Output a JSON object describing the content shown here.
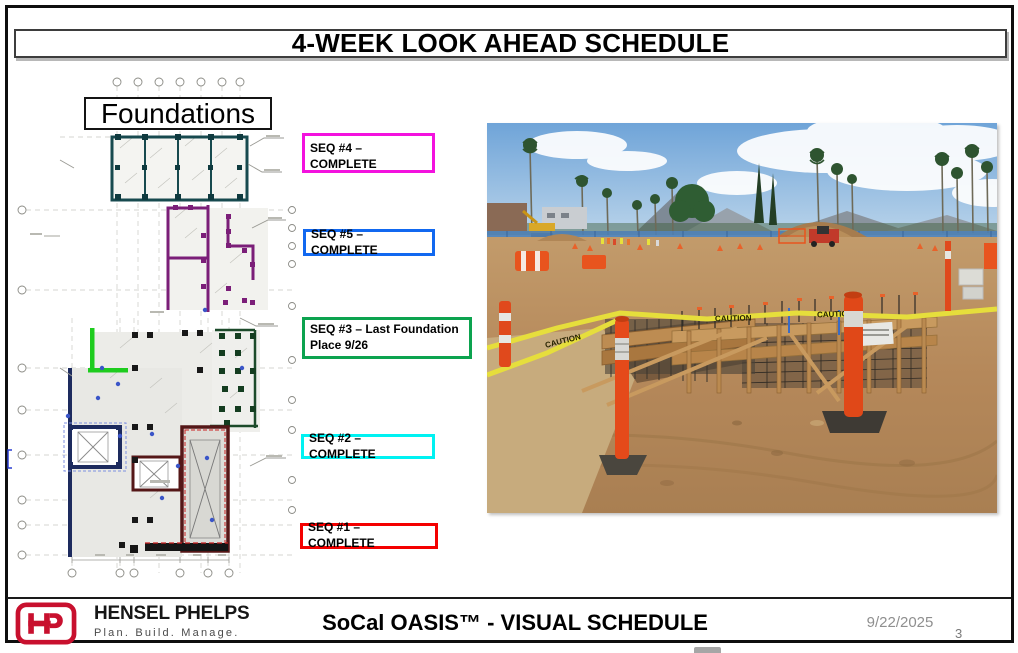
{
  "slide": {
    "title": "4-WEEK LOOK AHEAD SCHEDULE",
    "date": "9/22/2025",
    "page_number": "3"
  },
  "plan": {
    "label": "Foundations"
  },
  "sequence_labels": [
    {
      "id": "seq-4",
      "lines": [
        "SEQ #4 – COMPLETE"
      ],
      "border_color": "#F312DE"
    },
    {
      "id": "seq-5",
      "lines": [
        "SEQ #5 – COMPLETE"
      ],
      "border_color": "#1168F0"
    },
    {
      "id": "seq-3",
      "lines": [
        "SEQ #3 – Last Foundation",
        "Place 9/26"
      ],
      "border_color": "#0CA34F"
    },
    {
      "id": "seq-2",
      "lines": [
        "SEQ #2 – COMPLETE"
      ],
      "border_color": "#00F2F2"
    },
    {
      "id": "seq-1",
      "lines": [
        "SEQ #1 – COMPLETE"
      ],
      "border_color": "#F40000"
    }
  ],
  "photo": {
    "alt": "Construction site: foundation formwork with rebar, yellow caution tape, orange delineator posts, dirt field, blue perimeter fence, palm trees and mountains",
    "caution_tape_text": "CAUTION"
  },
  "footer": {
    "logo_monogram": "HP",
    "company": "HENSEL PHELPS",
    "tagline": "Plan. Build. Manage.",
    "schedule_title": "SoCal OASIS™ - VISUAL SCHEDULE",
    "date": "9/22/2025",
    "page": "3",
    "brand_red": "#C8102E"
  }
}
